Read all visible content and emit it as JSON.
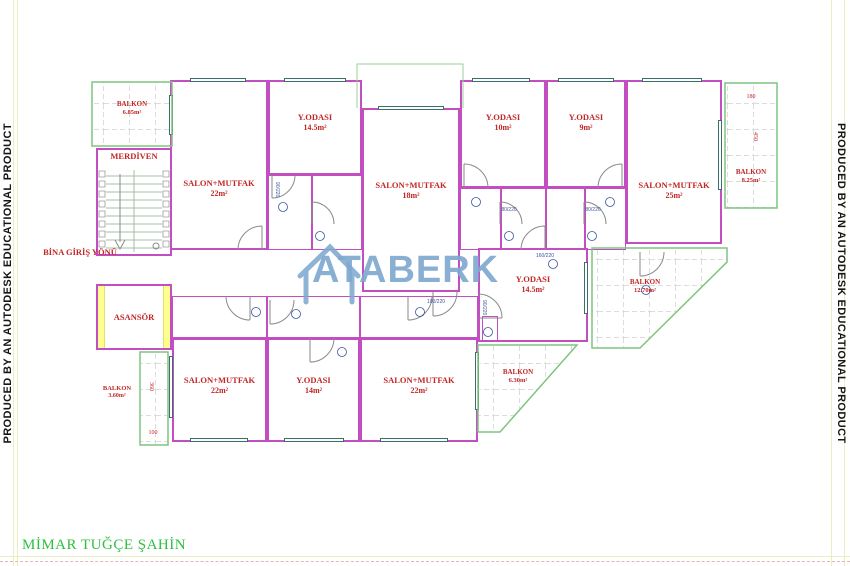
{
  "banners": {
    "left": "PRODUCED BY AN AUTODESK EDUCATIONAL PRODUCT",
    "right": "PRODUCED BY AN AUTODESK EDUCATIONAL PRODUCT"
  },
  "signature": "MİMAR TUĞÇE ŞAHİN",
  "watermark": {
    "text": "ATABERK"
  },
  "rooms": {
    "balkon_tl": {
      "name": "BALKON",
      "area": "6.85m²"
    },
    "merdiven": {
      "name": "MERDİVEN",
      "area": ""
    },
    "salon_tl": {
      "name": "SALON+MUTFAK",
      "area": "22m²"
    },
    "yodasi_tl": {
      "name": "Y.ODASI",
      "area": "14.5m²"
    },
    "salon_tm": {
      "name": "SALON+MUTFAK",
      "area": "18m²"
    },
    "yodasi_tm1": {
      "name": "Y.ODASI",
      "area": "10m²"
    },
    "yodasi_tm2": {
      "name": "Y.ODASI",
      "area": "9m²"
    },
    "salon_tr": {
      "name": "SALON+MUTFAK",
      "area": "25m²"
    },
    "balkon_tr": {
      "name": "BALKON",
      "area": "8.25m²"
    },
    "giris": {
      "name": "BİNA GİRİŞ YÖNÜ",
      "area": ""
    },
    "asansor": {
      "name": "ASANSÖR",
      "area": ""
    },
    "yodasi_mr": {
      "name": "Y.ODASI",
      "area": "14.5m²"
    },
    "balkon_mr": {
      "name": "BALKON",
      "area": "12.70m²"
    },
    "balkon_bl": {
      "name": "BALKON",
      "area": "3.60m²"
    },
    "salon_bl": {
      "name": "SALON+MUTFAK",
      "area": "22m²"
    },
    "yodasi_b": {
      "name": "Y.ODASI",
      "area": "14m²"
    },
    "salon_br": {
      "name": "SALON+MUTFAK",
      "area": "22m²"
    },
    "balkon_br": {
      "name": "BALKON",
      "area": "6.30m²"
    }
  },
  "dims": {
    "d180": "180",
    "d450": "450",
    "d100": "100",
    "d360": "360"
  },
  "door_tags": {
    "t1": "90/220",
    "t2": "80/220",
    "t3": "80/220",
    "t4": "160/220",
    "t5": "100/220",
    "t6": "90/220"
  },
  "colors": {
    "wall": "#c24ec2",
    "balcony": "#7fc47f",
    "label": "#c22626",
    "watermark": "#7fa9cf",
    "signature": "#2fbf3f",
    "elevator": "#ffff8f"
  }
}
